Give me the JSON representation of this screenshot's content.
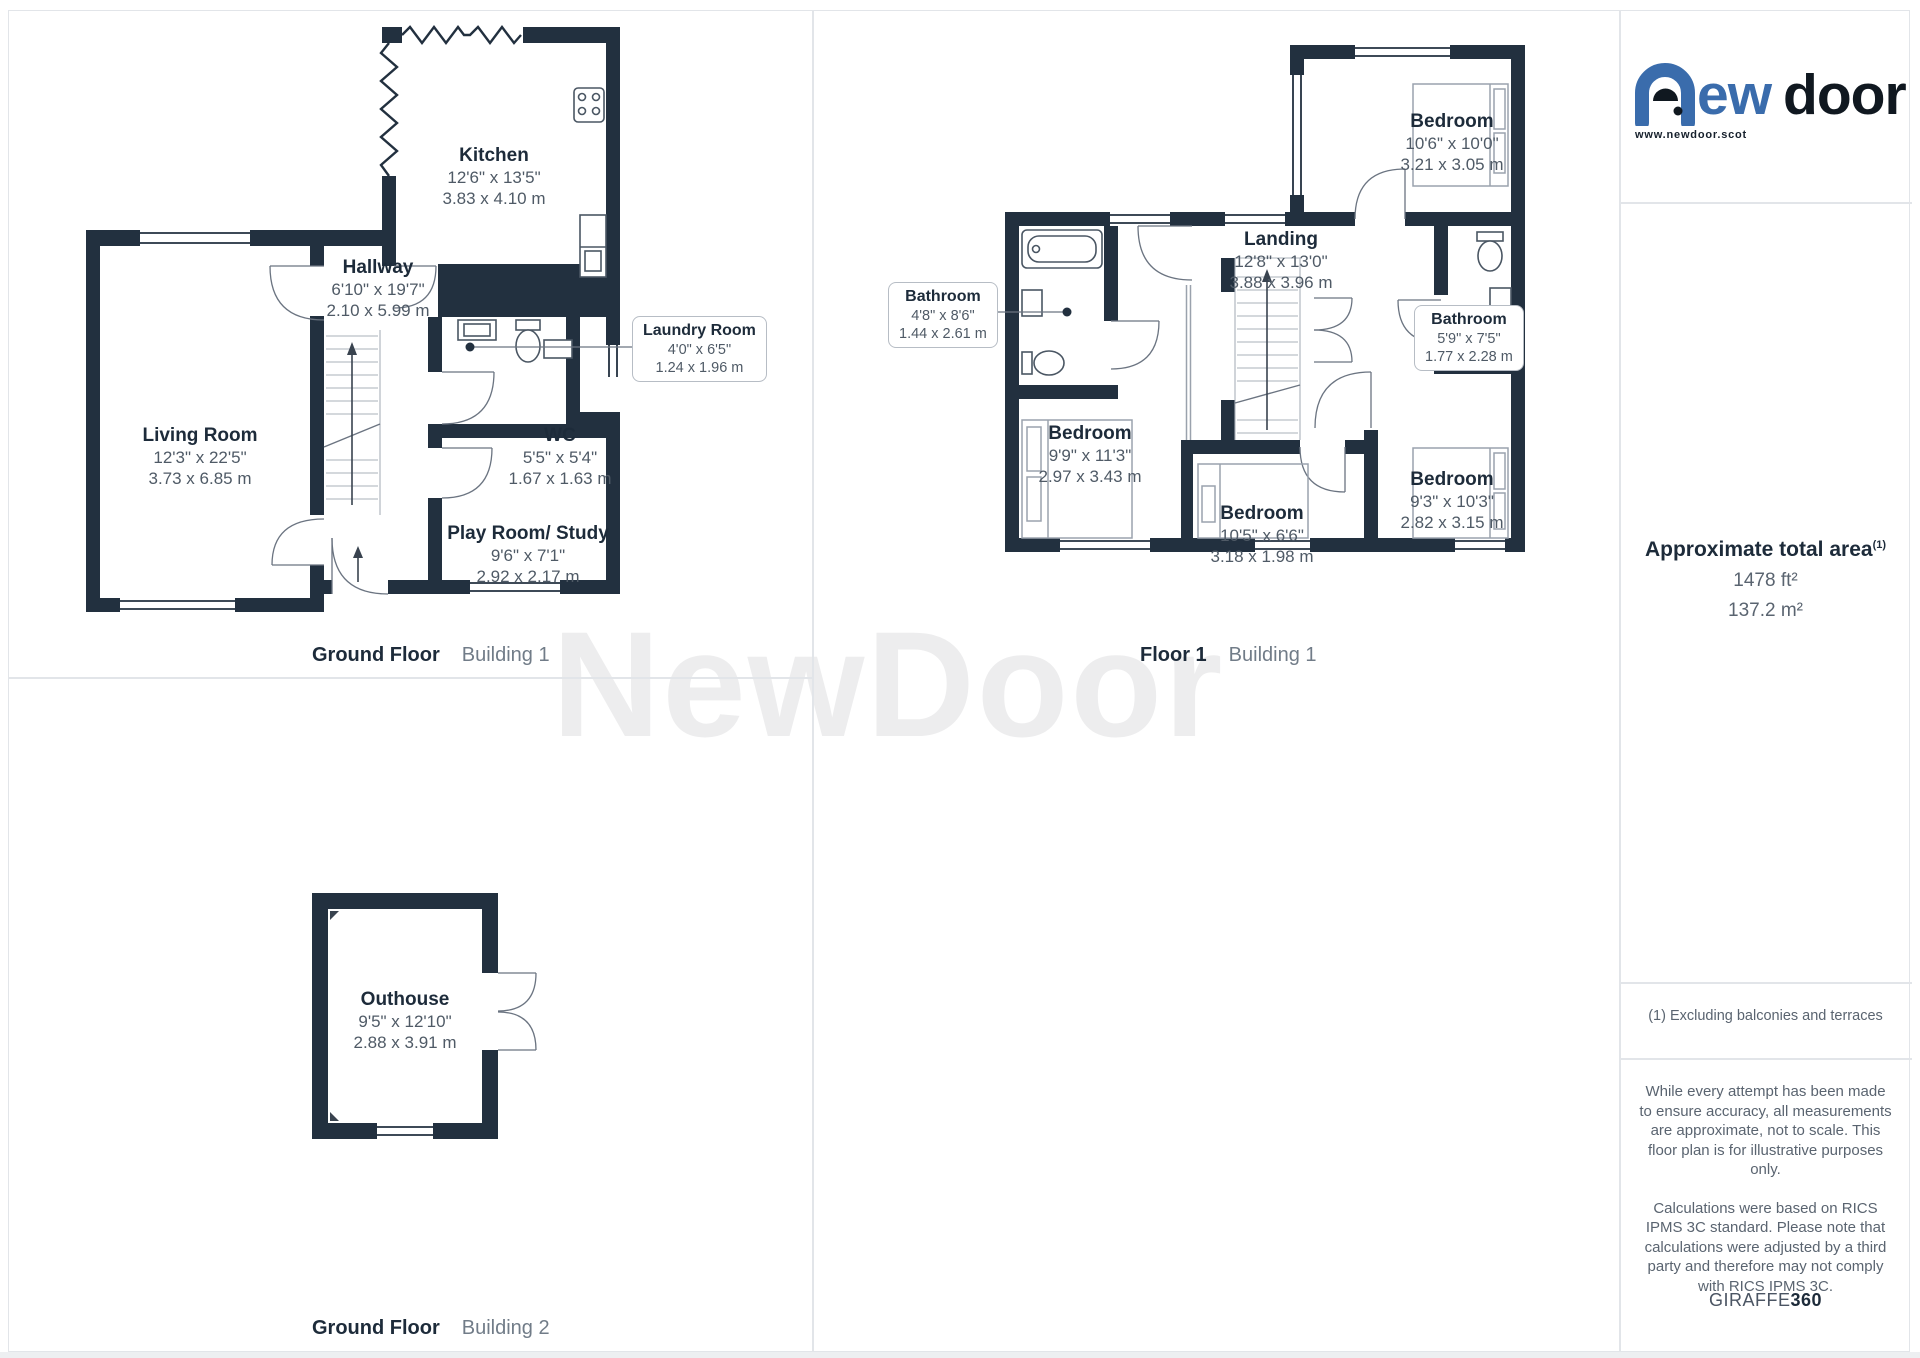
{
  "watermark": "NewDoor",
  "logo": {
    "text_blue_rest": "ew",
    "text_black": "door",
    "website": "www.newdoor.scot"
  },
  "captions": [
    {
      "bold": "Ground Floor",
      "light": "Building 1"
    },
    {
      "bold": "Floor 1",
      "light": "Building 1"
    },
    {
      "bold": "Ground Floor",
      "light": "Building 2"
    }
  ],
  "rooms": {
    "living": {
      "name": "Living Room",
      "imp": "12'3\" x 22'5\"",
      "met": "3.73 x 6.85 m"
    },
    "hallway": {
      "name": "Hallway",
      "imp": "6'10\" x 19'7\"",
      "met": "2.10 x 5.99 m"
    },
    "kitchen": {
      "name": "Kitchen",
      "imp": "12'6\" x 13'5\"",
      "met": "3.83 x 4.10 m"
    },
    "laundry": {
      "name": "Laundry Room",
      "imp": "4'0\" x 6'5\"",
      "met": "1.24 x 1.96 m"
    },
    "wc": {
      "name": "WC",
      "imp": "5'5\" x 5'4\"",
      "met": "1.67 x 1.63 m"
    },
    "playroom": {
      "name": "Play Room/ Study",
      "imp": "9'6\" x 7'1\"",
      "met": "2.92 x 2.17 m"
    },
    "bathroom1": {
      "name": "Bathroom",
      "imp": "4'8\" x 8'6\"",
      "met": "1.44 x 2.61 m"
    },
    "landing": {
      "name": "Landing",
      "imp": "12'8\" x 13'0\"",
      "met": "3.88 x 3.96 m"
    },
    "bedroom_top": {
      "name": "Bedroom",
      "imp": "10'6\" x 10'0\"",
      "met": "3.21 x 3.05 m"
    },
    "bathroom2": {
      "name": "Bathroom",
      "imp": "5'9\" x 7'5\"",
      "met": "1.77 x 2.28 m"
    },
    "bedroom_left": {
      "name": "Bedroom",
      "imp": "9'9\" x 11'3\"",
      "met": "2.97 x 3.43 m"
    },
    "bedroom_mid": {
      "name": "Bedroom",
      "imp": "10'5\" x 6'6\"",
      "met": "3.18 x 1.98 m"
    },
    "bedroom_right": {
      "name": "Bedroom",
      "imp": "9'3\" x 10'3\"",
      "met": "2.82 x 3.15 m"
    },
    "outhouse": {
      "name": "Outhouse",
      "imp": "9'5\" x 12'10\"",
      "met": "2.88 x 3.91 m"
    }
  },
  "sidebar": {
    "area_title": "Approximate total area",
    "area_sup": "(1)",
    "area_ft": "1478 ft²",
    "area_m": "137.2 m²",
    "footnote": "(1) Excluding balconies and terraces",
    "disclaimer1": "While every attempt has been made to ensure accuracy, all measurements are approximate, not to scale. This floor plan is for illustrative purposes only.",
    "disclaimer2": "Calculations were based on RICS IPMS 3C standard. Please note that calculations were adjusted by a third party and therefore may not comply with RICS IPMS 3C.",
    "giraffe_normal": "GIRAFFE",
    "giraffe_bold": "360"
  },
  "colors": {
    "wall": "#22303f",
    "accent_blue": "#3a6cac",
    "text_dark": "#1d2b3a",
    "text_gray": "#5a6470"
  }
}
